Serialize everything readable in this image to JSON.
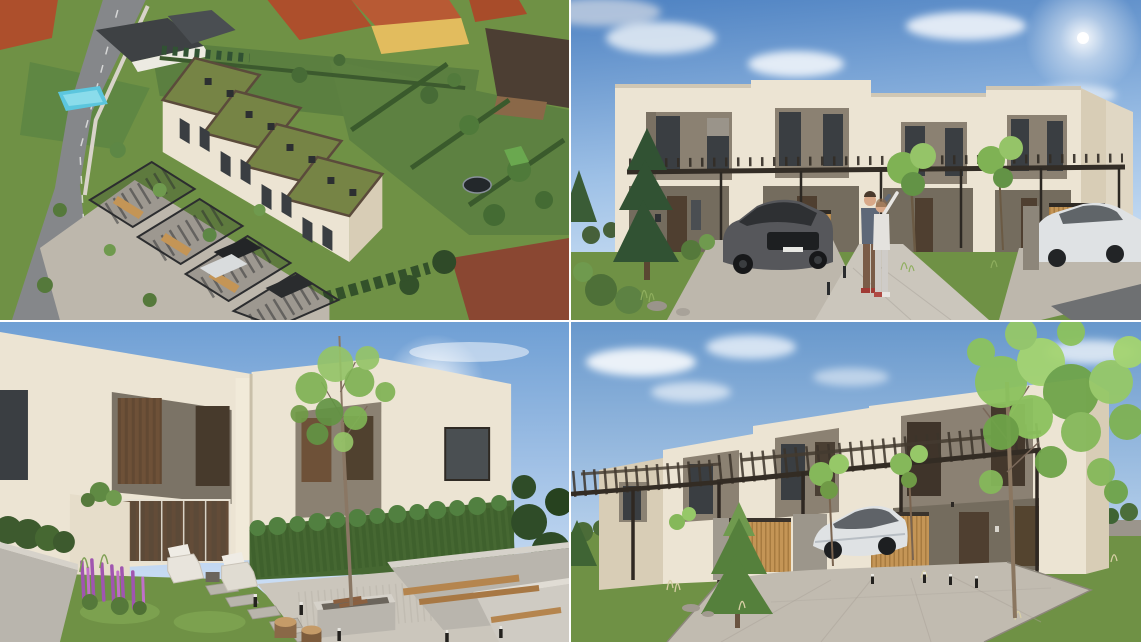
{
  "document": {
    "title": "Townhouse development - four architectural renderings",
    "visible_text": []
  },
  "layout": {
    "grid": "2x2",
    "gutter_px": 2,
    "gutter_color": "#ffffff"
  },
  "panels": [
    {
      "id": "aerial-view",
      "label": "Aerial drone view of a row of four townhouses with green sedum roofs, steel carport pergolas, paved driveways and private gardens among existing houses, a street on the left and a neighbouring pool"
    },
    {
      "id": "street-elevation",
      "label": "Street-level front view of four flat-roofed townhouses with grey facade panels, a continuous carport pergola, a dark grey SUV, a couple taking a selfie on the walkway and a white car on the right"
    },
    {
      "id": "garden-view",
      "label": "Rear garden view with lawn, purple lupine flowers, stepping stones, gravel terrace, concrete fire-pit planter with a slender birch tree, wooden bench on a concrete wall, tree-trunk stools and tall thuja hedges"
    },
    {
      "id": "driveway-view",
      "label": "Angled front view of the townhouse row with dark timber carport pergolas, larch slat screens, a white crossover parked under the carport, a paved driveway, young trees and lawns"
    }
  ],
  "colors": {
    "gutter": "#ffffff",
    "facade-cream": "#ece4d3",
    "facade-shade": "#d8cdb6",
    "panel-gray": "#8b8172",
    "panel-gray-dark": "#746c5e",
    "window-dark": "#3a3e42",
    "window-warm": "#6e5138",
    "door-brown": "#4f3f30",
    "pergola": "#332d26",
    "wood-slat": "#c49556",
    "wood-dark": "#91662f",
    "grass": "#6f9145",
    "grass-dark": "#4f7034",
    "grass-light": "#86ab57",
    "hedge": "#466832",
    "conifer": "#315233",
    "leaf": "#7fb254",
    "leaf-light": "#95c468",
    "paving": "#bdb7ac",
    "paving-light": "#cbc6bc",
    "asphalt": "#85878a",
    "roof-red": "#ad4f2c",
    "roof-dark": "#423a32",
    "green-roof": "#768445",
    "parapet": "#5b4b3b",
    "pool": "#5cc6de",
    "car-dark": "#56575b",
    "car-white": "#dfe2e4",
    "concrete": "#b9b5ad",
    "concrete-light": "#d6d2ca",
    "stone": "#9b958c",
    "flower-purple": "#a055b0",
    "skin": "#d8a888",
    "sky-deep": "#4e82c2",
    "sky-pale": "#d7e7f7"
  }
}
